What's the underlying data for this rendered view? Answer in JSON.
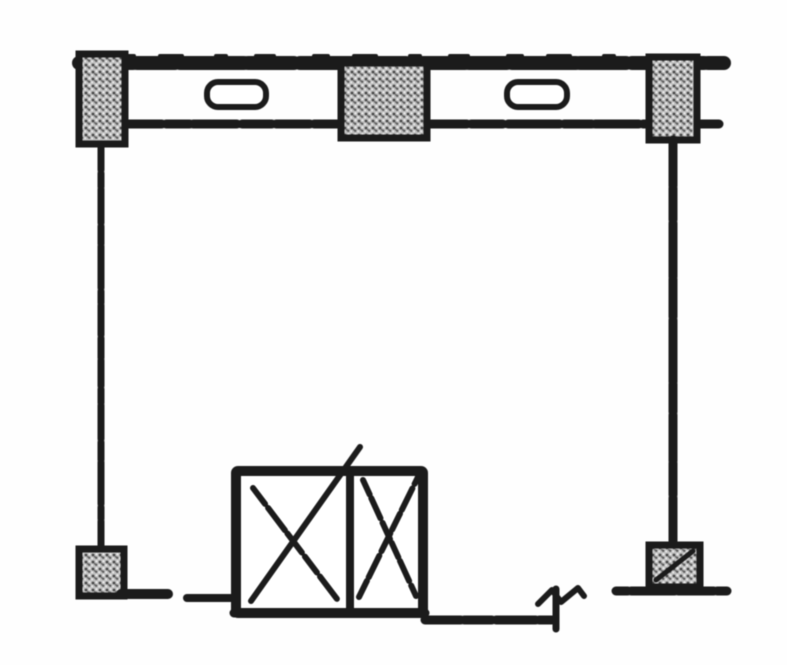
{
  "page": {
    "kind": "scanned-floor-plan-fragment",
    "description": "Black-and-white scanned architectural floor plan of a single room bay: top exterior wall band with two window openings and three hatched columns, open room, and a double elevator/shaft box with X marks at the bottom wall",
    "colors": {
      "paper": "#fdfdfd",
      "ink": "#1f1f1f",
      "hatch_base": "#bdbdbd",
      "hatch_mark": "#474747",
      "hatch_light": "#f0f0f0"
    }
  },
  "plan": {
    "canvas": {
      "width": 787,
      "height": 665
    },
    "elements": [
      {
        "name": "top-wall-outer-line",
        "type": "line",
        "x1": 79,
        "y1": 63,
        "x2": 724,
        "y2": 63,
        "w": 14,
        "dash": "54 4 38 5 64 4 46 6 72 4 30 5"
      },
      {
        "name": "top-wall-outer-rough",
        "type": "line",
        "x1": 120,
        "y1": 56,
        "x2": 640,
        "y2": 56,
        "w": 4,
        "dash": "14 26 22 34 10 30 18 40"
      },
      {
        "name": "top-wall-inner-line-left",
        "type": "line",
        "x1": 128,
        "y1": 124,
        "x2": 341,
        "y2": 124,
        "w": 9,
        "dash": "34 4 24 3 44 5 30 4"
      },
      {
        "name": "top-wall-inner-line-right",
        "type": "line",
        "x1": 427,
        "y1": 124,
        "x2": 723,
        "y2": 124,
        "w": 9,
        "dash": "40 4 32 5 52 4 28 3 44 4"
      },
      {
        "name": "window-opening-left",
        "type": "rect",
        "x": 207,
        "y": 82,
        "w": 59,
        "h": 25,
        "sw": 6,
        "rx": 11,
        "fill": "paper"
      },
      {
        "name": "window-opening-right",
        "type": "rect",
        "x": 507,
        "y": 82,
        "w": 60,
        "h": 25,
        "sw": 6,
        "rx": 11,
        "fill": "paper"
      },
      {
        "name": "column-top-left",
        "type": "hatchrect",
        "x": 79,
        "y": 54,
        "w": 46,
        "h": 90,
        "sw": 7
      },
      {
        "name": "column-top-center",
        "type": "hatchrect",
        "x": 341,
        "y": 63,
        "w": 86,
        "h": 75,
        "sw": 7
      },
      {
        "name": "column-top-right",
        "type": "hatchrect",
        "x": 649,
        "y": 57,
        "w": 48,
        "h": 83,
        "sw": 7
      },
      {
        "name": "left-wall-line",
        "type": "line",
        "x1": 101,
        "y1": 144,
        "x2": 101,
        "y2": 551,
        "w": 7,
        "dash": "26 3 14 2 34 3 18 2 42 3 12 2 30 3 20 2"
      },
      {
        "name": "right-wall-line",
        "type": "line",
        "x1": 673,
        "y1": 140,
        "x2": 673,
        "y2": 547,
        "w": 9,
        "dash": "46 2 32 3 54 2 38 3 62 2 28 3"
      },
      {
        "name": "column-bottom-left",
        "type": "hatchrect",
        "x": 79,
        "y": 549,
        "w": 45,
        "h": 47,
        "sw": 7
      },
      {
        "name": "column-bottom-right",
        "type": "hatchrect",
        "x": 649,
        "y": 545,
        "w": 51,
        "h": 42,
        "sw": 7
      },
      {
        "name": "column-bottom-right-slash",
        "type": "line",
        "x1": 656,
        "y1": 580,
        "x2": 693,
        "y2": 551,
        "w": 5
      },
      {
        "name": "bottom-wall-left-segment",
        "type": "line",
        "x1": 121,
        "y1": 594,
        "x2": 168,
        "y2": 594,
        "w": 10
      },
      {
        "name": "bottom-wall-left-dash",
        "type": "line",
        "x1": 187,
        "y1": 598,
        "x2": 233,
        "y2": 598,
        "w": 8
      },
      {
        "name": "elevator-shaft-box",
        "type": "rect",
        "x": 236,
        "y": 471,
        "w": 187,
        "h": 142,
        "sw": 10,
        "rx": 2,
        "fill": "paper"
      },
      {
        "name": "elevator-shaft-divider",
        "type": "line",
        "x1": 350,
        "y1": 475,
        "x2": 350,
        "y2": 610,
        "w": 8
      },
      {
        "name": "elevator-left-x-stroke-a",
        "type": "line",
        "x1": 253,
        "y1": 488,
        "x2": 337,
        "y2": 599,
        "w": 6,
        "dash": "20 5 28 4 24 5"
      },
      {
        "name": "elevator-left-x-stroke-b",
        "type": "line",
        "x1": 251,
        "y1": 601,
        "x2": 360,
        "y2": 447,
        "w": 6
      },
      {
        "name": "elevator-right-x-stroke-a",
        "type": "line",
        "x1": 363,
        "y1": 480,
        "x2": 416,
        "y2": 596,
        "w": 6,
        "dash": "16 4 22 5 18 4"
      },
      {
        "name": "elevator-right-x-stroke-b",
        "type": "line",
        "x1": 359,
        "y1": 597,
        "x2": 418,
        "y2": 477,
        "w": 6,
        "dash": "18 4 24 5 20 4"
      },
      {
        "name": "elevator-box-bottom-edge",
        "type": "line",
        "x1": 234,
        "y1": 613,
        "x2": 425,
        "y2": 613,
        "w": 9,
        "dash": "20 4 28 5 16 4 32 5 22 4"
      },
      {
        "name": "bottom-wall-right-segment",
        "type": "line",
        "x1": 425,
        "y1": 620,
        "x2": 552,
        "y2": 620,
        "w": 9,
        "dash": "36 3 28 4 40 3"
      },
      {
        "name": "wall-break-tick",
        "type": "line",
        "x1": 556,
        "y1": 589,
        "x2": 556,
        "y2": 629,
        "w": 7
      },
      {
        "name": "wall-break-zigzag",
        "type": "polyline",
        "points": "538,604 552,590 561,602 578,588 584,596",
        "w": 6
      },
      {
        "name": "bottom-wall-far-right-segment",
        "type": "line",
        "x1": 616,
        "y1": 591,
        "x2": 727,
        "y2": 591,
        "w": 9,
        "dash": "12 3 44 3 36 3"
      }
    ]
  }
}
